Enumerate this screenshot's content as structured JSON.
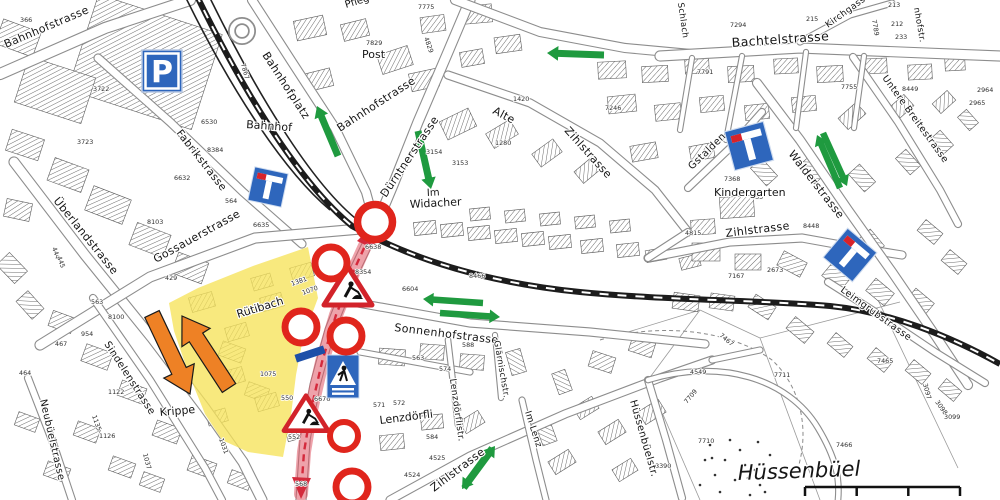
{
  "map": {
    "title": "construction detour plan",
    "street_labels": [
      {
        "id": "bahnhofstrasse-nw",
        "text": "Bahnhofstrasse",
        "x": 6,
        "y": 48,
        "r": -23,
        "fs": 11
      },
      {
        "id": "bahnhofplatz",
        "text": "Bahnhofplatz",
        "x": 262,
        "y": 55,
        "r": 57,
        "fs": 11
      },
      {
        "id": "fabrikstrasse",
        "text": "Fabrikstrasse",
        "x": 176,
        "y": 133,
        "r": 52,
        "fs": 10.5
      },
      {
        "id": "bahnhofstrasse-center",
        "text": "Bahnhofstrasse",
        "x": 340,
        "y": 132,
        "r": -33,
        "fs": 11
      },
      {
        "id": "duerntnerstrasse",
        "text": "Dürntnerstrasse",
        "x": 386,
        "y": 198,
        "r": -56,
        "fs": 11
      },
      {
        "id": "alte",
        "text": "Alte",
        "x": 492,
        "y": 113,
        "r": 28,
        "fs": 11
      },
      {
        "id": "alte-zihlstrasse",
        "text": "Zihlstrasse",
        "x": 564,
        "y": 131,
        "r": 48,
        "fs": 11
      },
      {
        "id": "bachtelstrasse",
        "text": "Bachtelstrasse",
        "x": 732,
        "y": 47,
        "r": -4,
        "fs": 12.5
      },
      {
        "id": "kirchgasse",
        "text": "Kirchgasse",
        "x": 828,
        "y": 28,
        "r": -36,
        "fs": 9
      },
      {
        "id": "nhofstr",
        "text": "nhofstr.",
        "x": 914,
        "y": 8,
        "r": 80,
        "fs": 8.5
      },
      {
        "id": "untere-breitestrasse",
        "text": "Untere Breitestrasse",
        "x": 882,
        "y": 78,
        "r": 54,
        "fs": 9.5
      },
      {
        "id": "schlach",
        "text": "Schlach",
        "x": 678,
        "y": 3,
        "r": 82,
        "fs": 8.5
      },
      {
        "id": "gstalden",
        "text": "Gstalden",
        "x": 692,
        "y": 170,
        "r": -44,
        "fs": 10
      },
      {
        "id": "walderstrasse",
        "text": "Walderstrasse",
        "x": 788,
        "y": 154,
        "r": 52,
        "fs": 11
      },
      {
        "id": "zihlstrasse-mid",
        "text": "Zihlstrasse",
        "x": 726,
        "y": 237,
        "r": -7,
        "fs": 11
      },
      {
        "id": "leimgrubstrasse",
        "text": "Leimgrubstrasse",
        "x": 840,
        "y": 291,
        "r": 36,
        "fs": 9.5
      },
      {
        "id": "ueberlandstrasse",
        "text": "Überlandstrasse",
        "x": 53,
        "y": 201,
        "r": 51,
        "fs": 11
      },
      {
        "id": "gossauerstrasse",
        "text": "Gossauerstrasse",
        "x": 156,
        "y": 263,
        "r": -29,
        "fs": 11
      },
      {
        "id": "sonnenhofstrasse",
        "text": "Sonnenhofstrasse",
        "x": 394,
        "y": 331,
        "r": 7,
        "fs": 11
      },
      {
        "id": "zihlstrasse-s",
        "text": "Zihlstrasse",
        "x": 434,
        "y": 492,
        "r": -37,
        "fs": 11
      },
      {
        "id": "sindelenstrasse",
        "text": "Sindelenstrasse",
        "x": 104,
        "y": 344,
        "r": 57,
        "fs": 10
      },
      {
        "id": "neubuelstrasse",
        "text": "Neubüelstrasse",
        "x": 40,
        "y": 400,
        "r": 77,
        "fs": 10
      },
      {
        "id": "huessenbuelstr",
        "text": "Hüssenbüelstr.",
        "x": 630,
        "y": 401,
        "r": 74,
        "fs": 10
      },
      {
        "id": "lenzdoerflistr",
        "text": "Lenzdörflistr.",
        "x": 450,
        "y": 379,
        "r": 82,
        "fs": 9
      },
      {
        "id": "glaernischstr",
        "text": "Glärnischstr.",
        "x": 494,
        "y": 341,
        "r": 80,
        "fs": 8.5
      },
      {
        "id": "im-lenz",
        "text": "Im Lenz",
        "x": 525,
        "y": 412,
        "r": 72,
        "fs": 9
      }
    ],
    "place_labels": [
      {
        "id": "post",
        "text": "Post",
        "x": 362,
        "y": 58,
        "r": 0,
        "fs": 11
      },
      {
        "id": "pflegeheim",
        "text": "Pflegeheim",
        "x": 346,
        "y": 8,
        "r": -17,
        "fs": 10
      },
      {
        "id": "bahnhof",
        "text": "Bahnhof",
        "x": 246,
        "y": 128,
        "r": 4,
        "fs": 11
      },
      {
        "id": "im-widacher-1",
        "text": "Im",
        "x": 427,
        "y": 196,
        "r": -3,
        "fs": 10
      },
      {
        "id": "im-widacher-2",
        "text": "Widacher",
        "x": 410,
        "y": 208,
        "r": -3,
        "fs": 11
      },
      {
        "id": "kindergarten",
        "text": "Kindergarten",
        "x": 714,
        "y": 196,
        "r": 0,
        "fs": 11
      },
      {
        "id": "krippe",
        "text": "Krippe",
        "x": 160,
        "y": 416,
        "r": -5,
        "fs": 11
      },
      {
        "id": "ruetibach",
        "text": "Rütibach",
        "x": 238,
        "y": 318,
        "r": -17,
        "fs": 11
      },
      {
        "id": "lenzdoerfli",
        "text": "Lenzdörfli",
        "x": 380,
        "y": 424,
        "r": -7,
        "fs": 11
      },
      {
        "id": "huessenbuel",
        "text": "Hüssenbüel",
        "x": 738,
        "y": 480,
        "r": -2,
        "fs": 21,
        "cls": "it"
      }
    ],
    "parcel_numbers": [
      [
        "366",
        20,
        22
      ],
      [
        "3722",
        93,
        91
      ],
      [
        "3723",
        77,
        144
      ],
      [
        "6530",
        201,
        124
      ],
      [
        "8384",
        207,
        152
      ],
      [
        "7867",
        241,
        64,
        75
      ],
      [
        "7775",
        418,
        9
      ],
      [
        "7829",
        366,
        45
      ],
      [
        "4829",
        424,
        38,
        70
      ],
      [
        "1420",
        513,
        101
      ],
      [
        "1280",
        495,
        145
      ],
      [
        "3153",
        452,
        165
      ],
      [
        "3154",
        426,
        154
      ],
      [
        "7246",
        605,
        110
      ],
      [
        "7294",
        730,
        27
      ],
      [
        "215",
        806,
        21
      ],
      [
        "213",
        888,
        7
      ],
      [
        "212",
        891,
        26
      ],
      [
        "233",
        895,
        39
      ],
      [
        "7789",
        872,
        20,
        80
      ],
      [
        "7791",
        697,
        74
      ],
      [
        "7755",
        841,
        89
      ],
      [
        "8449",
        902,
        91
      ],
      [
        "2964",
        977,
        92
      ],
      [
        "2965",
        969,
        105
      ],
      [
        "6632",
        174,
        180
      ],
      [
        "8103",
        147,
        224
      ],
      [
        "6635",
        253,
        227
      ],
      [
        "564",
        225,
        203
      ],
      [
        "563",
        91,
        304
      ],
      [
        "429",
        165,
        280
      ],
      [
        "8100",
        108,
        319
      ],
      [
        "954",
        81,
        336
      ],
      [
        "444",
        52,
        248,
        70
      ],
      [
        "445",
        57,
        257,
        70
      ],
      [
        "6638",
        365,
        249
      ],
      [
        "8354",
        355,
        274
      ],
      [
        "8466",
        469,
        278
      ],
      [
        "6604",
        402,
        291
      ],
      [
        "1381",
        292,
        286,
        -20
      ],
      [
        "1070",
        303,
        295,
        -20
      ],
      [
        "1075",
        260,
        376
      ],
      [
        "550",
        281,
        400
      ],
      [
        "552",
        288,
        439
      ],
      [
        "568",
        295,
        486
      ],
      [
        "6676",
        314,
        401
      ],
      [
        "635",
        751,
        199
      ],
      [
        "7368",
        724,
        181
      ],
      [
        "8448",
        803,
        228
      ],
      [
        "4815",
        685,
        235
      ],
      [
        "7167",
        728,
        278
      ],
      [
        "2673",
        767,
        272
      ],
      [
        "3092",
        753,
        155
      ],
      [
        "7465",
        877,
        363
      ],
      [
        "7466",
        836,
        447
      ],
      [
        "7711",
        774,
        377
      ],
      [
        "7709",
        687,
        404,
        -50
      ],
      [
        "7710",
        698,
        443
      ],
      [
        "4549",
        690,
        374
      ],
      [
        "8390",
        655,
        468
      ],
      [
        "3097",
        923,
        384,
        75
      ],
      [
        "3098",
        935,
        402,
        55
      ],
      [
        "3099",
        944,
        419
      ],
      [
        "7467",
        719,
        336,
        40
      ],
      [
        "588",
        462,
        347
      ],
      [
        "563",
        412,
        360
      ],
      [
        "574",
        439,
        371
      ],
      [
        "572",
        393,
        405
      ],
      [
        "571",
        373,
        407
      ],
      [
        "584",
        426,
        439
      ],
      [
        "4525",
        429,
        460
      ],
      [
        "4524",
        404,
        477
      ],
      [
        "1126",
        99,
        438
      ],
      [
        "1122",
        108,
        394
      ],
      [
        "1135",
        92,
        416,
        70
      ],
      [
        "467",
        55,
        346
      ],
      [
        "464",
        19,
        375
      ],
      [
        "1037",
        143,
        454,
        75
      ],
      [
        "1031",
        219,
        439,
        70
      ]
    ],
    "signs": {
      "parking_label": "P",
      "dead_end_sign_count": 3,
      "road_closed_sign_count": 6,
      "roadworks_sign_count": 2,
      "pedestrian_crossing_sign_count": 1
    },
    "overlays": {
      "construction_zone": "yellow highlighted area around Rütibach",
      "closed_route": "red highlighted Dürntnerstrasse section with dashed centerline",
      "detour_arrows_green_count": 9,
      "diversion_arrows_orange_count": 2
    },
    "colors": {
      "construction_zone": "#F6E35A",
      "closed_route": "#E05565",
      "closed_route_line": "#D42A3C",
      "detour_arrow": "#1F9A3F",
      "diversion_arrow": "#EE8125",
      "sign_blue": "#2E66BC",
      "sign_red": "#D8232A"
    },
    "scale_bar": {
      "segments": 3
    }
  }
}
